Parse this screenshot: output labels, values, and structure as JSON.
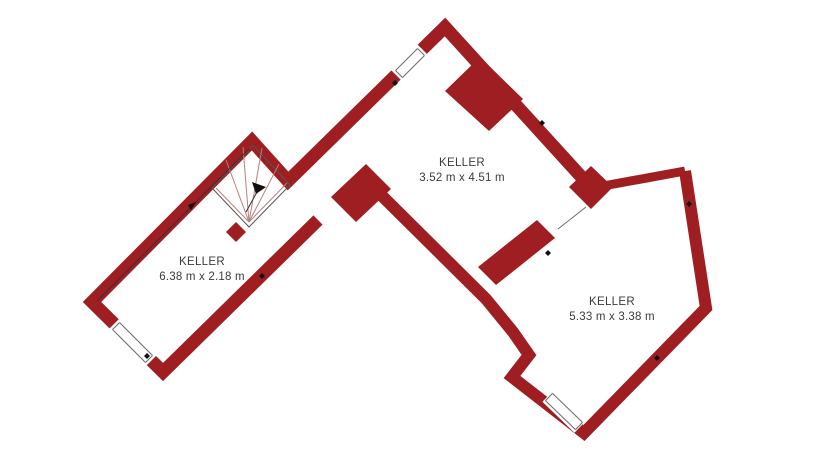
{
  "floorplan": {
    "background": "#ffffff",
    "wall_color": "#9E1E21",
    "stair_line_color": "#b5807f",
    "thin_line_color": "#6b6b6b",
    "text_color": "#3b3b3b",
    "rooms": [
      {
        "name": "KELLER",
        "dimensions": "3.52 m x 4.51 m",
        "width_m": 3.52,
        "depth_m": 4.51
      },
      {
        "name": "KELLER",
        "dimensions": "6.38 m x 2.18 m",
        "width_m": 6.38,
        "depth_m": 2.18
      },
      {
        "name": "KELLER",
        "dimensions": "5.33 m x 3.38 m",
        "width_m": 5.33,
        "depth_m": 3.38
      }
    ],
    "window_count": 3,
    "staircase": "winder-stair"
  }
}
